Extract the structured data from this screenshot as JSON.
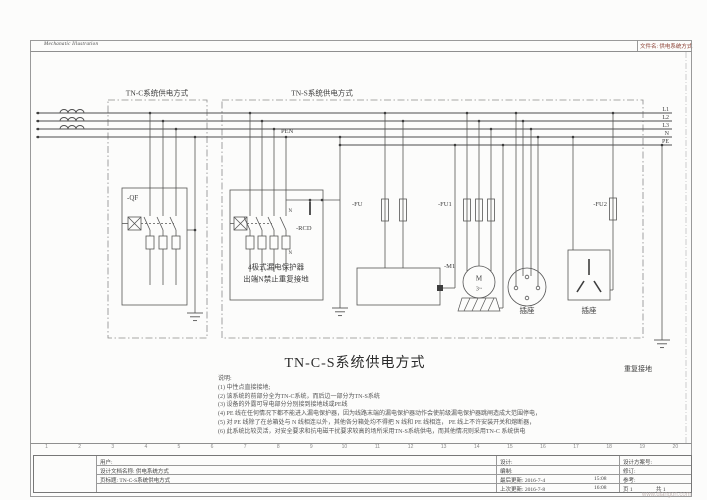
{
  "header": {
    "brand": "Mechanatic Illustration",
    "filename": "文件名: 供电系统方式"
  },
  "bus": {
    "l1": "L1",
    "l2": "L2",
    "l3": "L3",
    "n": "N",
    "pe": "PE",
    "pen": "PEN"
  },
  "zones": {
    "tnc": "TN-C系统供电方式",
    "tns": "TN-S系统供电方式"
  },
  "devices": {
    "qf": "-QF",
    "rcd": "-RCD",
    "rcd_line1": "4极式漏电保护器",
    "rcd_line2": "出端N禁止重复接地",
    "n_in": "N",
    "n_out": "N",
    "fu": "-FU",
    "fu1": "-FU1",
    "fu2": "-FU2",
    "m1": "-M1",
    "motor_letter": "M",
    "motor_phases": "3~",
    "socket_round": "插座",
    "socket_flat": "插座",
    "repeat_ground": "重复接地"
  },
  "title": "TN-C-S系统供电方式",
  "notes": {
    "heading": "说明:",
    "items": [
      "(1) 中性点直接接地;",
      "(2) 该系统的前部分全为TN-C系统，而后边一部分为TN-S系统",
      "(3) 设备的外露可导电部分分别接到接地线或PE线",
      "(4) PE 线在任何情况下都不能进入漏电保护器，因为线路末端的漏电保护器动作会使前级漏电保护器跳闸造成大范围停电，",
      "(5) 对 PE 线除了在总箱处与 N 线相连以外，其他各分箱处均不得把 N 线和 PE 线相连， PE 线上不许安装开关和熔断器，",
      "(6) 此系统比较灵活，对安全要求和抗电磁干扰要求较高的场所采用TN-S系统供电，而其他情况则采用TN-C 系统供电"
    ]
  },
  "ruler": {
    "cols": [
      "1",
      "2",
      "3",
      "4",
      "5",
      "6",
      "7",
      "8",
      "9",
      "10",
      "11",
      "12",
      "13",
      "14",
      "15",
      "16",
      "17",
      "18",
      "19",
      "20"
    ]
  },
  "titleblock": {
    "customer": "用户:",
    "doc_name": "设计文档名称: 供电系统方式",
    "page_title": "页标题: TN-C-S系统供电方式",
    "designer": "设计:",
    "author": "编制:",
    "last_update": "最后更新: 2016-7-4",
    "last_update_time": "15:08",
    "prev_update": "上次更新: 2016-7-8",
    "prev_update_time": "16:08",
    "scheme_no": "设计方案号:",
    "revision": "修订:",
    "reference": "参考:",
    "page": "页 1",
    "total": "共 1"
  },
  "watermark": "www.diangon.com"
}
